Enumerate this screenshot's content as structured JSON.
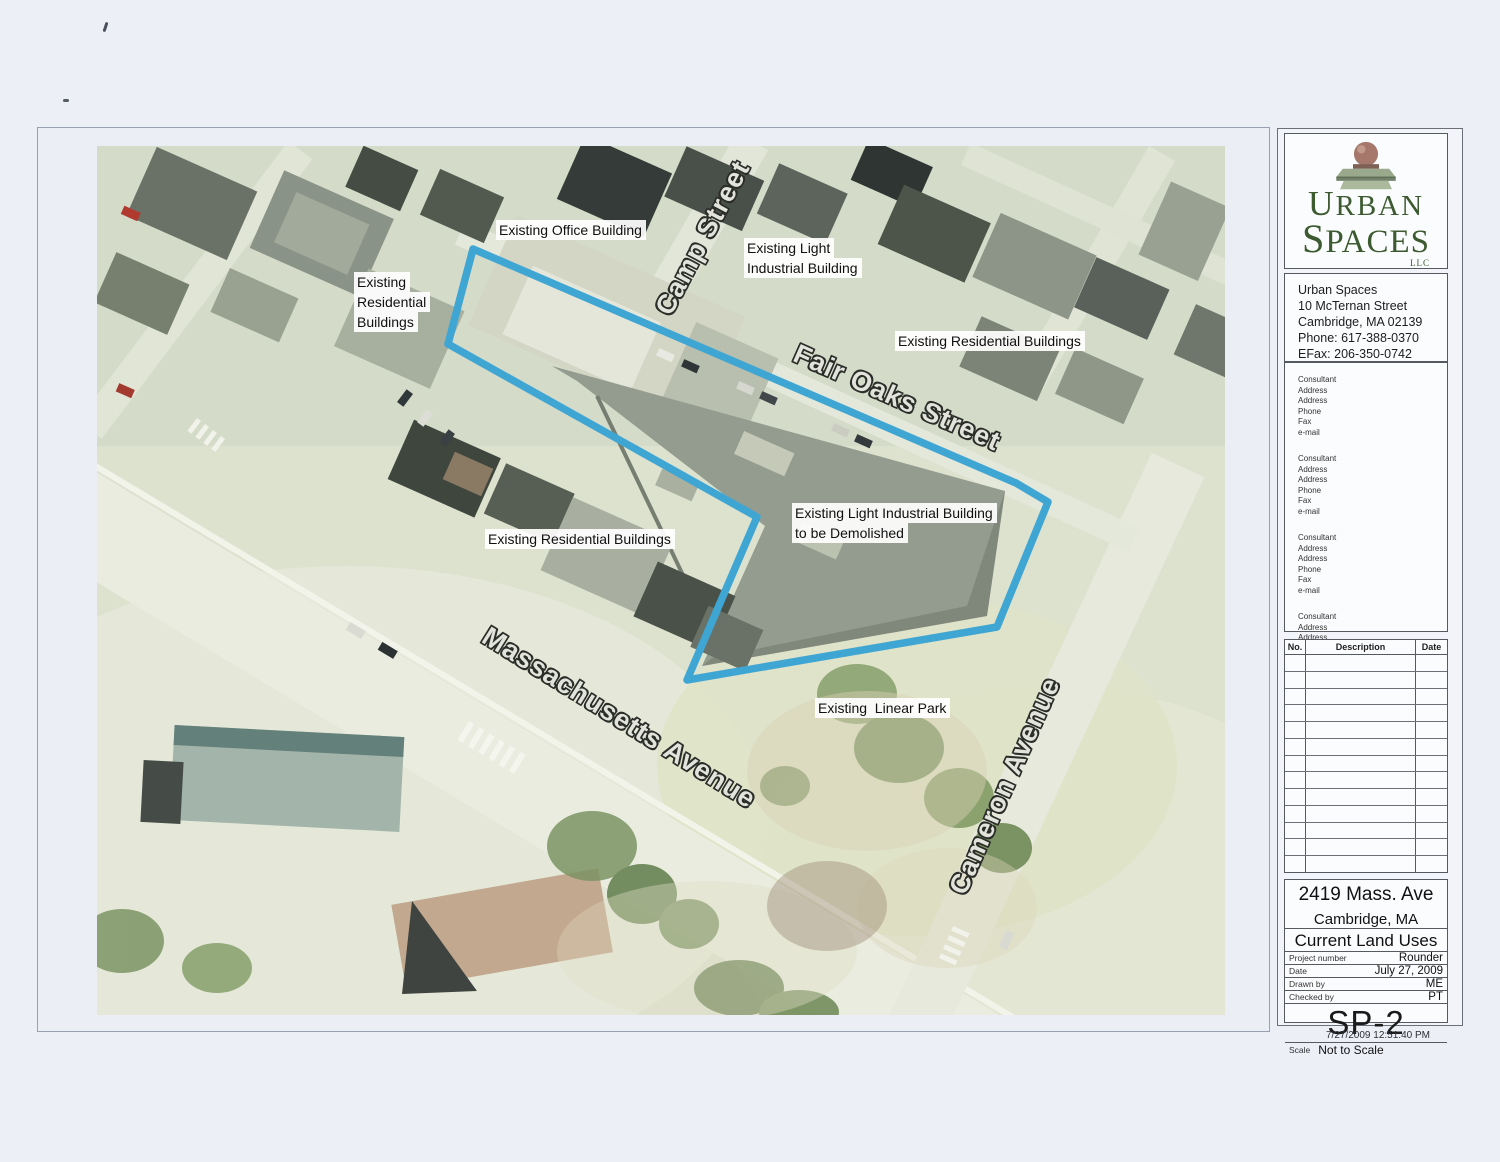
{
  "map": {
    "site_outline_color": "#3fa6d4",
    "site_outline_points": "376,103 919,337 951,356 900,481 590,534 660,371 351,198",
    "streets": {
      "camp": "Camp Street",
      "fair_oaks": "Fair Oaks Street",
      "massachusetts": "Massachusetts Avenue",
      "cameron": "Cameron Avenue"
    },
    "labels": {
      "office": {
        "lines": [
          "Existing Office Building"
        ]
      },
      "light_industrial": {
        "lines": [
          "Existing Light",
          "Industrial Building"
        ]
      },
      "residential_west": {
        "lines": [
          "Existing",
          "Residential",
          "Buildings"
        ]
      },
      "residential_northeast": {
        "lines": [
          "Existing Residential Buildings"
        ]
      },
      "residential_south": {
        "lines": [
          "Existing Residential Buildings"
        ]
      },
      "demolish": {
        "lines": [
          "Existing Light Industrial Building",
          "to be Demolished"
        ]
      },
      "linear_park": {
        "lines": [
          "Existing  Linear Park"
        ]
      }
    }
  },
  "title_block": {
    "logo": {
      "line1": "URBAN",
      "line2": "SPACES",
      "suffix": "LLC"
    },
    "firm": {
      "name": "Urban Spaces",
      "address1": "10 McTernan Street",
      "address2": "Cambridge, MA  02139",
      "phone": "Phone: 617-388-0370",
      "efax": "EFax: 206-350-0742"
    },
    "consultant_template": {
      "lines": [
        "Consultant",
        "Address",
        "Address",
        "Phone",
        "Fax",
        "e-mail"
      ]
    },
    "revisions": {
      "headers": [
        "No.",
        "Description",
        "Date"
      ]
    },
    "project": {
      "address": "2419 Mass. Ave",
      "city": "Cambridge, MA",
      "sheet_title": "Current Land Uses",
      "fields": [
        {
          "label": "Project number",
          "value": "Rounder"
        },
        {
          "label": "Date",
          "value": "July 27, 2009"
        },
        {
          "label": "Drawn by",
          "value": "ME"
        },
        {
          "label": "Checked by",
          "value": "PT"
        }
      ],
      "sheet_number": "SP-2",
      "scale_label": "Scale",
      "scale_value": "Not to Scale"
    },
    "print_stamp": "7/27/2009 12:51:40 PM"
  }
}
